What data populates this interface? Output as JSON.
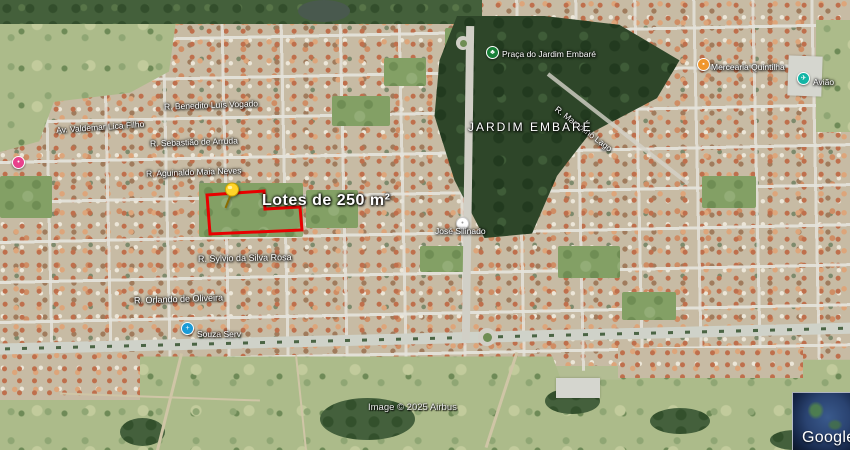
{
  "map": {
    "region_label": "JARDIM EMBARÉ",
    "lot_overlay_label": "Lotes de 250 m²",
    "attribution": "Image © 2025 Airbus",
    "google_logo": "Google",
    "streets": [
      {
        "name": "R. Benedito Luís Vogado"
      },
      {
        "name": "Av. Valdemar Lica Filho"
      },
      {
        "name": "R. Sebastião de Arruda"
      },
      {
        "name": "R. Aguinaldo Maia Neves"
      },
      {
        "name": "R. Sylvio da Silva Rosa"
      },
      {
        "name": "R. Orlando de Oliveira"
      },
      {
        "name": "R. Marcolino Lago"
      }
    ],
    "pois": [
      {
        "name": "Praça do Jardim Embaré",
        "type": "park",
        "glyph": "♣",
        "color": "#188038"
      },
      {
        "name": "Souza Serv",
        "type": "business",
        "glyph": "+",
        "color": "#1a9bd7"
      },
      {
        "name": "Mercearia Quintilha",
        "type": "grocery",
        "glyph": "▪",
        "color": "#f0962c"
      },
      {
        "name": "Avião",
        "type": "landmark",
        "glyph": "✈",
        "color": "#12b5a5"
      },
      {
        "name": "",
        "type": "poi",
        "glyph": "•",
        "color": "#e8418c"
      },
      {
        "name": "José Silinado",
        "type": "poi",
        "glyph": "•",
        "color": "#ffffff"
      }
    ],
    "colors": {
      "lot_outline": "#e80000",
      "pin_head": "#ffd42a",
      "road": "#d1cfc6",
      "forest": "#2e4629"
    }
  }
}
